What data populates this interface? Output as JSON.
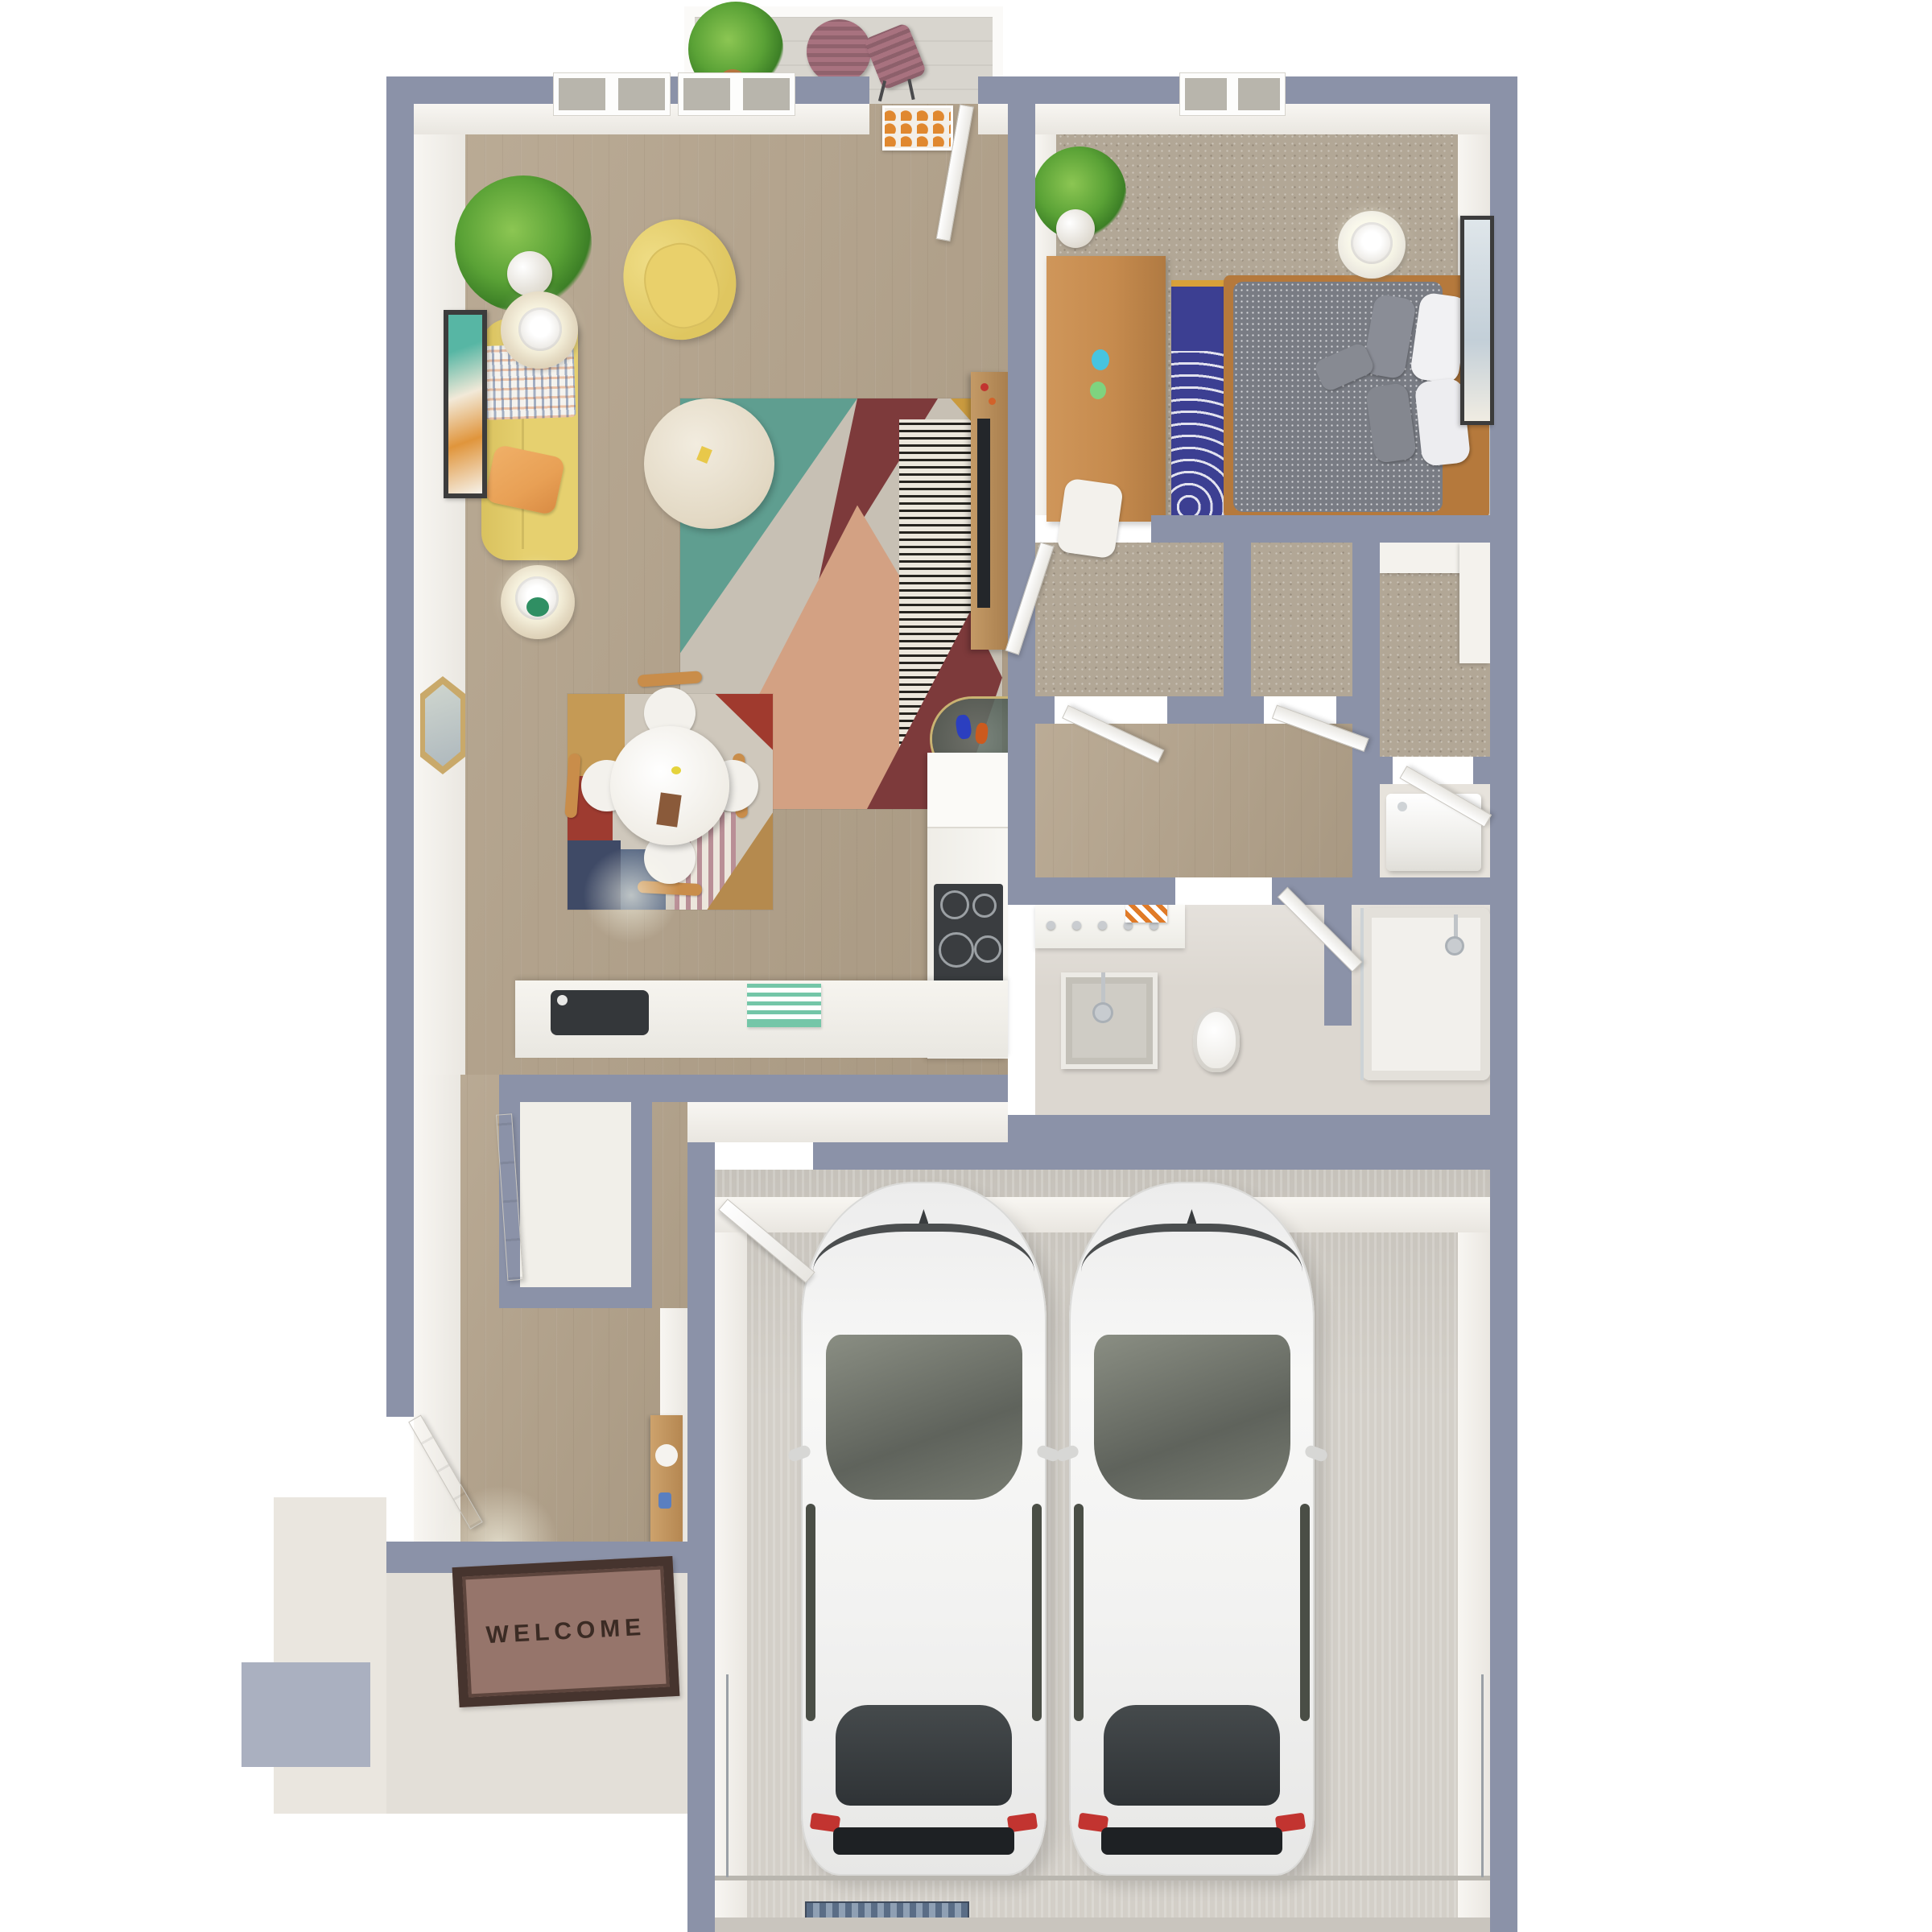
{
  "meta": {
    "kind": "3d-floor-plan-render",
    "description": "Top-down 3D floor plan of a one-bedroom apartment with living/dining room, kitchen, bathroom, closets, laundry, balcony, entry stoop and an attached two-car garage with two white cars parked inside."
  },
  "labels": {
    "welcome_mat": "WELCOME"
  },
  "colors": {
    "wall": "#8b92a8",
    "wall_light": "#aab0c0",
    "white_face": "#f6f4ef",
    "wood": "#b3a28a",
    "carpet": "#b2a796",
    "tile": "#dcd7d0",
    "garage_floor": "#d3cfc8",
    "patio": "#e3dfd8",
    "balcony": "#d8d5ce",
    "sofa": "#e6d06f",
    "pillow": "#e8a055",
    "rug_teal": "#5f9e90",
    "rug_red": "#7d3a3b",
    "rug_pink": "#d3a183",
    "bedroom_rug": "#3c3f92",
    "bed_frame": "#b5793c",
    "bed": "#797c84",
    "desk_wood": "#c68b4e",
    "table_mauve": "#a8727f",
    "plant": "#58a33c",
    "stove": "#3a3d40",
    "sink": "#34373a",
    "towel": "#e07b28",
    "car": "#f2f2f1",
    "car_glass": "#72766b",
    "taillight": "#c23430",
    "mat": "#96756b",
    "mat_border": "#46342e",
    "mat_text": "#3b2b24",
    "art_orange": "#e0882f",
    "glass_table": "#6d7a72",
    "vase_blue": "#2b3fc0",
    "vase_orange": "#cc5a1e",
    "tv": "#23262a",
    "mirror_gold": "#c9a96a"
  },
  "scene": {
    "rooms": [
      "balcony",
      "living-room",
      "dining-area",
      "kitchen",
      "bedroom",
      "closet-a",
      "closet-b",
      "walk-in-closet",
      "laundry-closet",
      "bathroom",
      "tub-room",
      "hallway",
      "entry",
      "front-stoop",
      "garage"
    ],
    "furniture": [
      "bistro-table",
      "bistro-chair",
      "potted-plants",
      "yellow-sofa",
      "yellow-armchair",
      "throw-blanket",
      "orange-pillow",
      "side-tables",
      "table-lamps",
      "coffee-table",
      "geometric-rug",
      "dining-table",
      "dining-chairs",
      "dining-rug",
      "media-console",
      "tv",
      "glass-console-table",
      "hexagon-mirror",
      "wall-art",
      "bed",
      "night-stand",
      "bedroom-desk",
      "desk-chair",
      "bedroom-rug",
      "vanity",
      "shower",
      "toilet",
      "bathtub",
      "washer",
      "cooktop",
      "kitchen-sink",
      "hall-closet-door",
      "entry-console",
      "welcome-mat",
      "white-car-left",
      "white-car-right",
      "garage-door-hardware"
    ]
  }
}
